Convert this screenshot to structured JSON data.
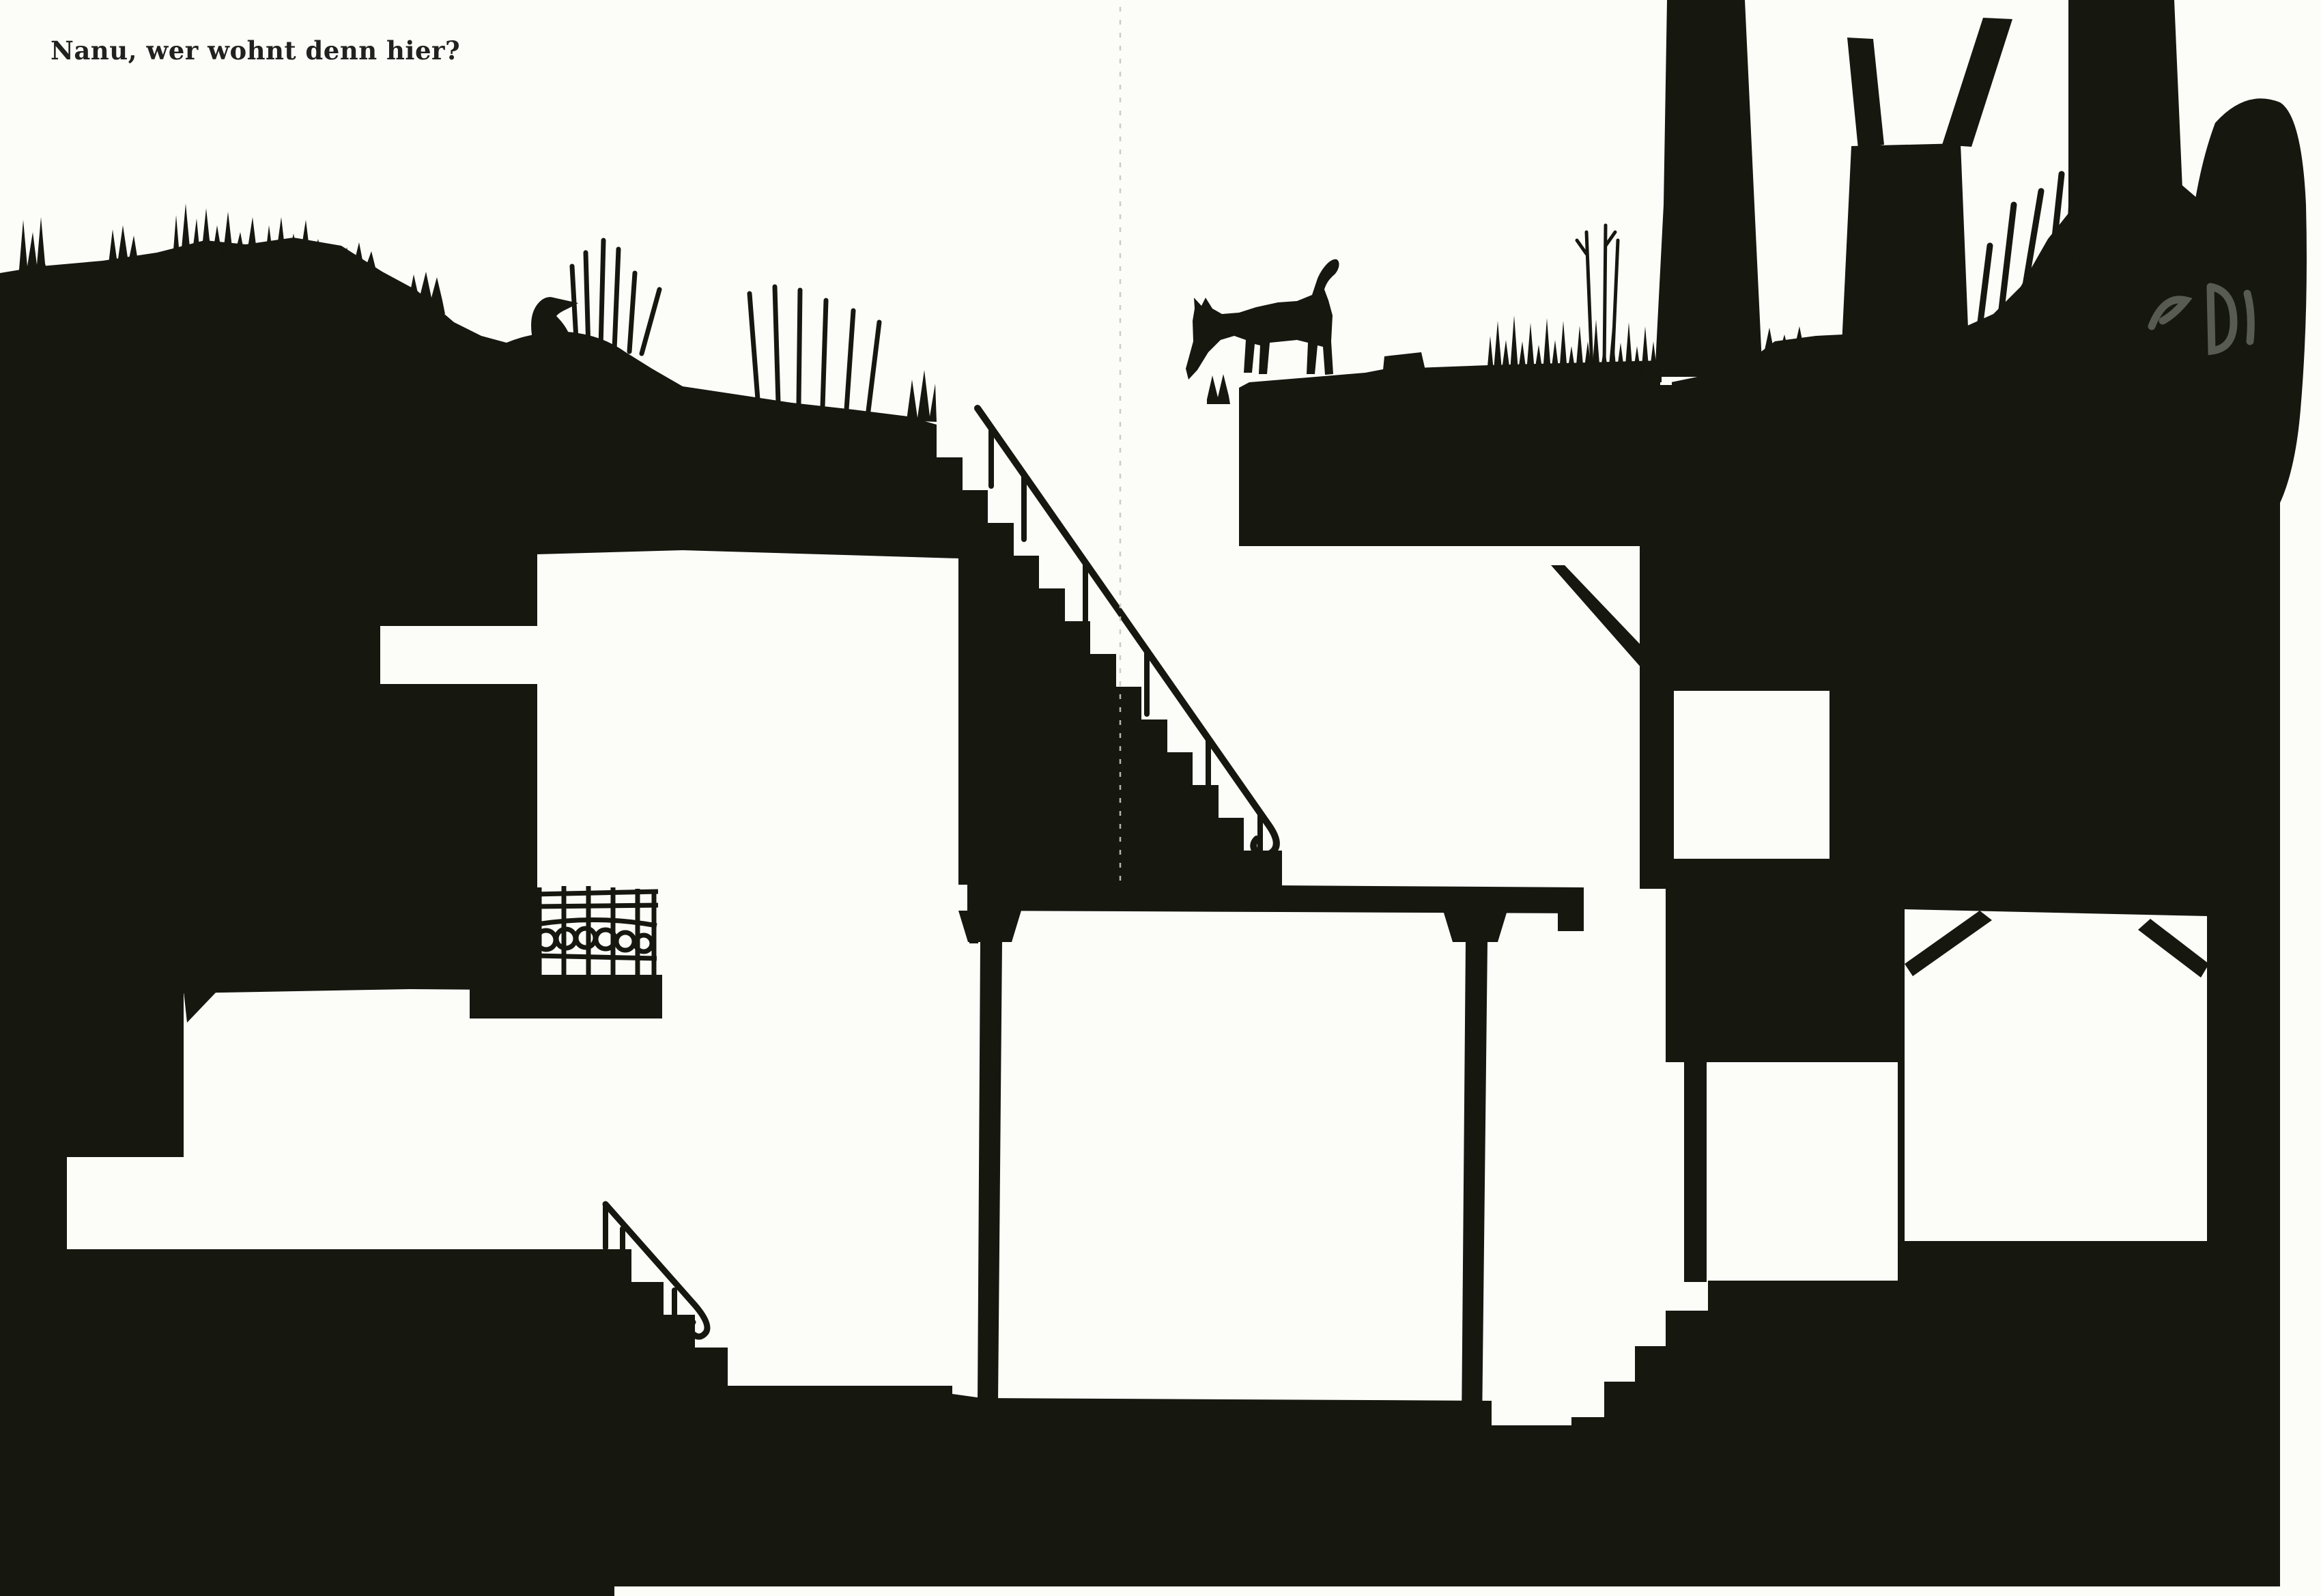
{
  "page": {
    "caption": "Nanu, wer wohnt denn hier?",
    "ink_color": "#16170f",
    "paper_color": "#fcfcf9",
    "artifact_color": "#6d7268"
  },
  "scene": {
    "type": "black-ink silhouette cross-section illustration (scanned picture-book page)",
    "elements": [
      "grassy ground surface with tufts and reeds",
      "perched crow on a mound",
      "sniffing dog with curled tail on a ledge",
      "large descending staircase with curled handrail",
      "small staircase with curled handrail",
      "underground room with two columns and beam",
      "left room with slot window and balcony railing with circle ornaments",
      "right-center room",
      "right room with diagonal roof braces",
      "three tree trunks and foliage at top right",
      "page fold line",
      "gray scanner smudge on right edge"
    ]
  }
}
